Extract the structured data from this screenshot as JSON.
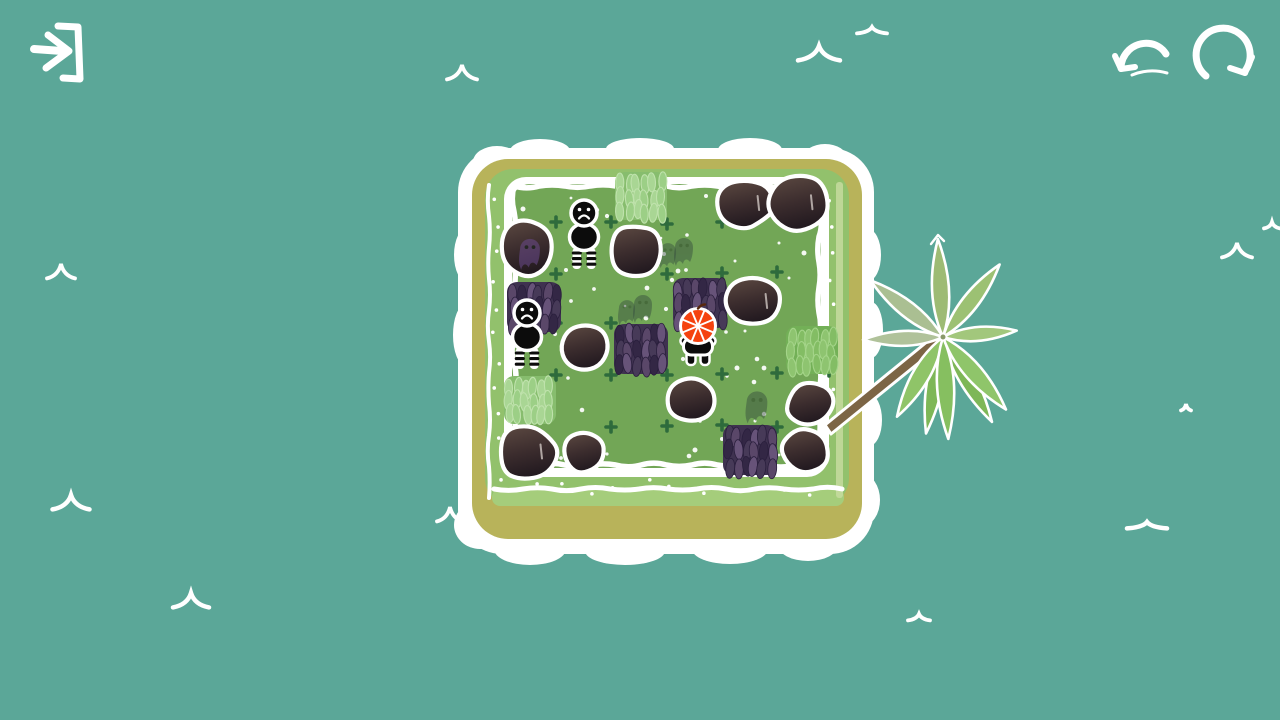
{
  "scene": {
    "kind": "island-puzzle-level",
    "width": 1280,
    "height": 720
  },
  "palette": {
    "water": "#5ba798",
    "foam": "#ffffff",
    "sand": "#b8b35a",
    "ring": "#92c16c",
    "ring_light": "#a5cd7b",
    "field": "#72a656",
    "plus_mark": "#2e6b3c",
    "speckle": "#ffffff",
    "rock_hi": "#5d4a42",
    "rock_mid": "#3c2d2e",
    "rock_lo": "#231a20",
    "bush_base": "#3f3250",
    "bush_blades": [
      "#5a4769",
      "#332745",
      "#675379",
      "#473a58"
    ],
    "tuft_pale_base": "#87bd6e",
    "tuft_pale_blades": [
      "#a9d694",
      "#9ccf86"
    ],
    "tuft_pale_stroke": "#bfe2ac",
    "tuft_green_base": "#73b057",
    "tuft_green_blades": [
      "#8ec470",
      "#83bd64"
    ],
    "tuft_green_stroke": "#a4d489",
    "ghost": "#33493d",
    "ghost_in_rock": "#6a4b8c",
    "monster_body": "#0c0c0c",
    "monster_outline": "#ffffff",
    "player_head": "#f5420f",
    "trunk": "#7c6545"
  },
  "hud": {
    "buttons": [
      {
        "id": "exit-button",
        "icon": "exit-arrow-bracket-icon",
        "label": "exit"
      },
      {
        "id": "undo-button",
        "icon": "undo-arrow-icon",
        "label": "undo"
      },
      {
        "id": "restart-button",
        "icon": "restart-loop-icon",
        "label": "restart"
      }
    ]
  },
  "ocean": {
    "waves": [
      {
        "x": 462,
        "y": 74,
        "w": 30,
        "t": "peak"
      },
      {
        "x": 819,
        "y": 55,
        "w": 42,
        "t": "peak"
      },
      {
        "x": 872,
        "y": 31,
        "w": 30,
        "t": "flat"
      },
      {
        "x": 61,
        "y": 273,
        "w": 28,
        "t": "peak"
      },
      {
        "x": 71,
        "y": 504,
        "w": 37,
        "t": "peak"
      },
      {
        "x": 191,
        "y": 602,
        "w": 36,
        "t": "peak"
      },
      {
        "x": 450,
        "y": 516,
        "w": 26,
        "t": "peak"
      },
      {
        "x": 919,
        "y": 618,
        "w": 22,
        "t": "flat"
      },
      {
        "x": 1147,
        "y": 526,
        "w": 40,
        "t": "flat"
      },
      {
        "x": 1237,
        "y": 252,
        "w": 30,
        "t": "peak"
      },
      {
        "x": 1272,
        "y": 226,
        "w": 16,
        "t": "flat"
      },
      {
        "x": 1186,
        "y": 408,
        "w": 10,
        "t": "flat"
      }
    ]
  },
  "island": {
    "plus_marks": [
      [
        556,
        222
      ],
      [
        611,
        222
      ],
      [
        667,
        224
      ],
      [
        722,
        222
      ],
      [
        556,
        274
      ],
      [
        667,
        274
      ],
      [
        722,
        273
      ],
      [
        777,
        272
      ],
      [
        556,
        323
      ],
      [
        611,
        323
      ],
      [
        556,
        375
      ],
      [
        611,
        375
      ],
      [
        667,
        375
      ],
      [
        722,
        374
      ],
      [
        777,
        373
      ],
      [
        829,
        371
      ],
      [
        611,
        427
      ],
      [
        667,
        426
      ],
      [
        722,
        425
      ],
      [
        777,
        427
      ]
    ]
  },
  "entities": {
    "boulders": [
      {
        "x": 527,
        "y": 247,
        "r": 30,
        "ghost": true
      },
      {
        "x": 636,
        "y": 249,
        "r": 28
      },
      {
        "x": 745,
        "y": 203,
        "r": 28,
        "shine": true
      },
      {
        "x": 797,
        "y": 203,
        "r": 31,
        "shine": true
      },
      {
        "x": 585,
        "y": 347,
        "r": 25
      },
      {
        "x": 753,
        "y": 301,
        "r": 28,
        "shine": true
      },
      {
        "x": 693,
        "y": 401,
        "r": 25
      },
      {
        "x": 809,
        "y": 403,
        "r": 24
      },
      {
        "x": 804,
        "y": 451,
        "r": 24
      },
      {
        "x": 527,
        "y": 452,
        "r": 30,
        "shine": true
      },
      {
        "x": 585,
        "y": 453,
        "r": 22
      }
    ],
    "bushes": [
      {
        "x": 534,
        "y": 307
      },
      {
        "x": 641,
        "y": 349
      },
      {
        "x": 700,
        "y": 303
      },
      {
        "x": 750,
        "y": 450
      }
    ],
    "tufts": [
      {
        "x": 641,
        "y": 196,
        "variant": "pale"
      },
      {
        "x": 530,
        "y": 400,
        "variant": "pale"
      },
      {
        "x": 812,
        "y": 350,
        "variant": "green"
      }
    ],
    "ghosts": [
      {
        "x": 684,
        "y": 249,
        "pair": true,
        "scale": 1.0
      },
      {
        "x": 643,
        "y": 306,
        "pair": true,
        "scale": 1.0
      },
      {
        "x": 757,
        "y": 404,
        "pair": false,
        "scale": 1.15
      }
    ],
    "monsters": [
      {
        "x": 584,
        "y": 228,
        "mood": "sad"
      },
      {
        "x": 527,
        "y": 328,
        "mood": "sad"
      }
    ],
    "player": {
      "x": 698,
      "y": 326,
      "head": "striped-orange"
    },
    "palm": {
      "cx": 943,
      "cy": 337,
      "trunk_base": [
        831,
        434
      ],
      "leaves": [
        {
          "a": 60,
          "len": 98,
          "w": 16,
          "c": "#7eb757"
        },
        {
          "a": 100,
          "len": 98,
          "w": 16,
          "c": "#7eb757"
        },
        {
          "a": -93,
          "len": 98,
          "w": 17,
          "c": "#9dbb74"
        },
        {
          "a": -142,
          "len": 92,
          "w": 16,
          "c": "#aabf92"
        },
        {
          "a": 178,
          "len": 80,
          "w": 15,
          "c": "#b0c29a"
        },
        {
          "a": 120,
          "len": 92,
          "w": 17,
          "c": "#8fc468"
        },
        {
          "a": 87,
          "len": 102,
          "w": 17,
          "c": "#86bf60"
        },
        {
          "a": 49,
          "len": 96,
          "w": 17,
          "c": "#8fc56a"
        },
        {
          "a": -5,
          "len": 74,
          "w": 14,
          "c": "#a2c77c"
        },
        {
          "a": -52,
          "len": 92,
          "w": 16,
          "c": "#9cc173"
        }
      ]
    }
  }
}
